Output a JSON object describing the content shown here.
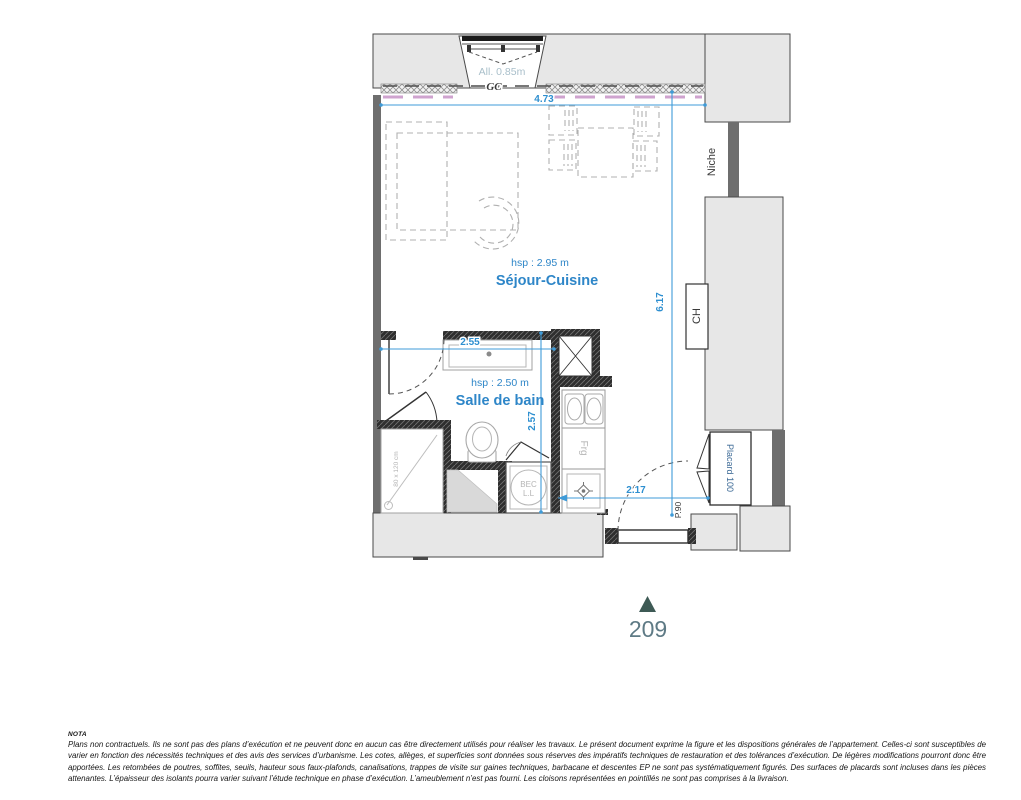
{
  "plan": {
    "window": {
      "allege_label": "All. 0.85m",
      "gc_label": "GC"
    },
    "sejour": {
      "hsp": "hsp : 2.95 m",
      "name": "Séjour-Cuisine"
    },
    "salle_de_bain": {
      "hsp": "hsp : 2.50 m",
      "name": "Salle de bain"
    },
    "dimensions": {
      "top_width": "4.73",
      "room_height": "6.17",
      "bath_width": "2.55",
      "bath_height": "2.57",
      "entry_width": "2.17"
    },
    "fixtures": {
      "niche": "Niche",
      "boiler": "CH",
      "closet": "Placard 100",
      "entry_door": "P.90",
      "shower_size": "80 x 120 cm",
      "fridge": "Frg",
      "washer_line1": "BEC",
      "washer_line2": "L.L"
    },
    "unit_number": "209",
    "colors": {
      "dimension_blue": "#3f9bd8",
      "room_label_blue": "#2e86c8",
      "allege_gray_blue": "#a9bfca",
      "partition_pink": "#cfa3cf",
      "marker_teal": "#3e5a55",
      "unit_number_color": "#5e7a85"
    }
  },
  "nota": {
    "title": "NOTA",
    "body": "Plans non contractuels. Ils ne sont pas des plans d’exécution et ne peuvent donc en aucun cas être directement utilisés pour réaliser les travaux. Le présent document exprime la figure et les dispositions générales de l’appartement. Celles-ci sont susceptibles de varier en fonction des nécessités techniques et des avis des services d’urbanisme. Les cotes, allèges, et superficies sont données sous réserves des impératifs techniques de restauration et des tolérances d’exécution. De légères modifications pourront donc être apportées. Les retombées de poutres, soffites, seuils, hauteur sous faux-plafonds, canalisations, trappes de visite sur gaines techniques, barbacane et descentes EP ne sont pas systématiquement figurés. Des surfaces de placards sont incluses dans les pièces attenantes. L’épaisseur des isolants pourra varier suivant l’étude technique en phase d’exécution. L’ameublement n’est pas fourni. Les cloisons représentées en pointillés ne sont pas comprises à la livraison."
  }
}
